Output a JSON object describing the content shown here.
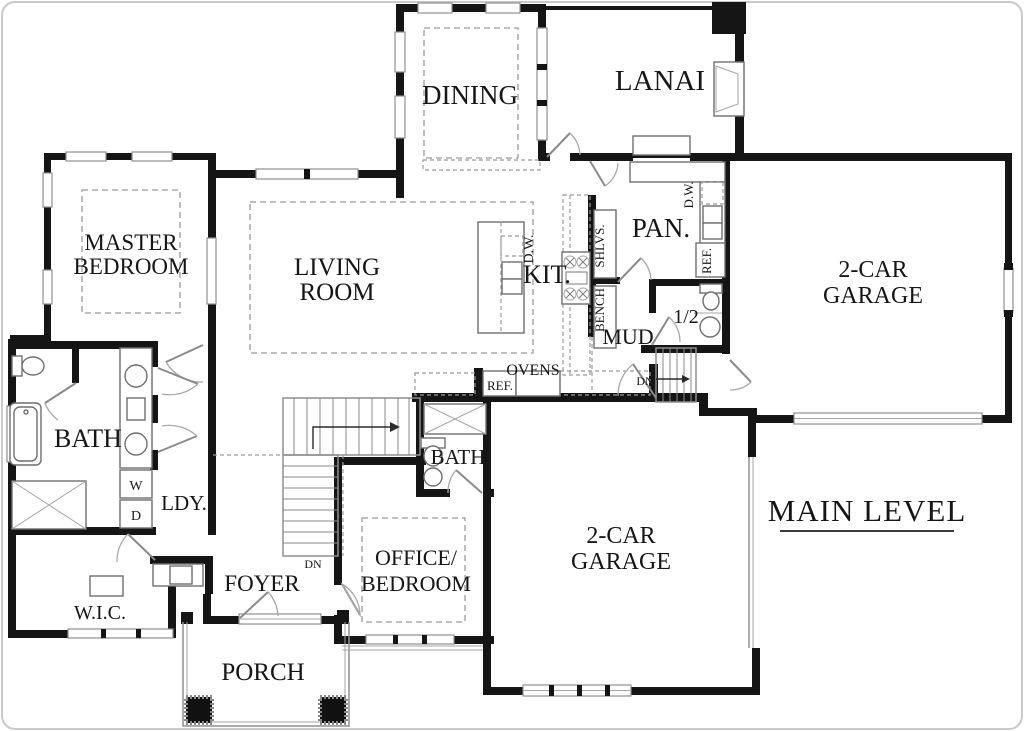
{
  "title": "MAIN LEVEL",
  "colors": {
    "wall": "#151515",
    "thin_line": "#8f8f8f",
    "dashed_line": "#9a9a9a",
    "text": "#161616",
    "frame_border": "#c9c9c9",
    "background": "#ffffff"
  },
  "labels": {
    "dining": "DINING",
    "lanai": "LANAI",
    "master1": "MASTER",
    "master2": "BEDROOM",
    "living1": "LIVING",
    "living2": "ROOM",
    "kitchen": "KIT.",
    "island_dw": "D.W.",
    "pantry": "PAN.",
    "pantry_dw": "D.W.",
    "pantry_ref": "REF.",
    "shelves": "SHLVS.",
    "bench": "BENCH",
    "mud": "MUD",
    "half_bath": "1/2",
    "garage_right1": "2-CAR",
    "garage_right2": "GARAGE",
    "garage_bottom1": "2-CAR",
    "garage_bottom2": "GARAGE",
    "master_bath": "BATH",
    "hall_bath": "BATH",
    "washer": "W",
    "dryer": "D",
    "laundry": "LDY.",
    "wic": "W.I.C.",
    "foyer": "FOYER",
    "porch": "PORCH",
    "office1": "OFFICE/",
    "office2": "BEDROOM",
    "ovens": "OVENS",
    "ref_kitchen": "REF.",
    "dn_foyer": "DN",
    "dn_basement": "DN",
    "main_level": "MAIN LEVEL"
  }
}
